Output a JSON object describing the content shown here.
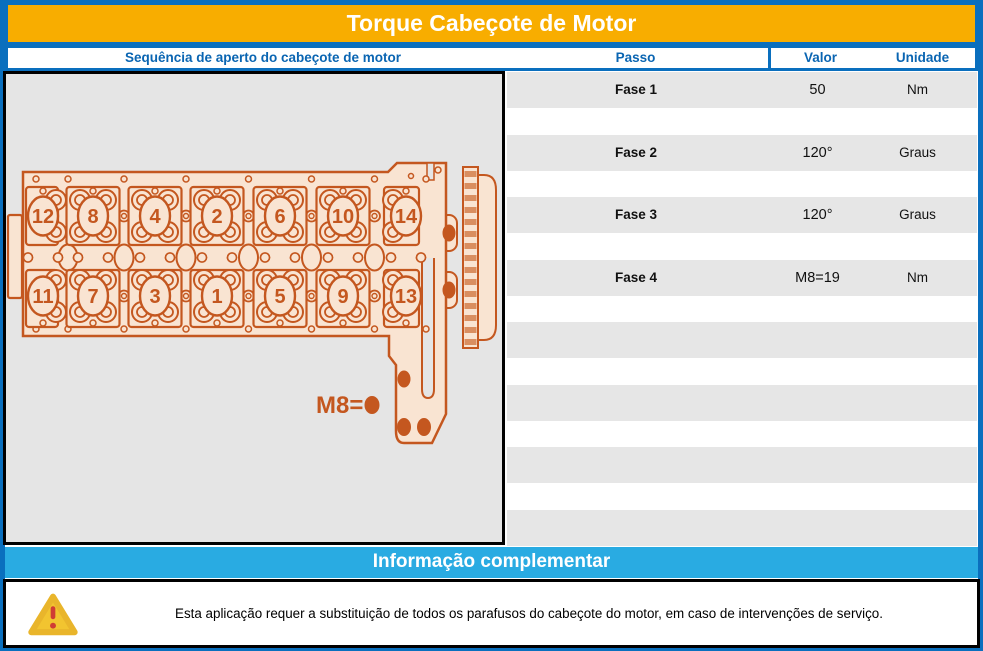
{
  "title": "Torque Cabeçote de Motor",
  "columns": {
    "sequence": "Sequência de aperto do cabeçote de motor",
    "passo": "Passo",
    "valor": "Valor",
    "unidade": "Unidade"
  },
  "torque_table": {
    "rows": [
      {
        "passo": "Fase 1",
        "valor": "50",
        "unidade": "Nm"
      },
      {
        "passo": "Fase 2",
        "valor": "120°",
        "unidade": "Graus"
      },
      {
        "passo": "Fase 3",
        "valor": "120°",
        "unidade": "Graus"
      },
      {
        "passo": "Fase 4",
        "valor": "M8=19",
        "unidade": "Nm"
      }
    ],
    "empty_rows": 4
  },
  "diagram": {
    "bolt_sequence_top": [
      12,
      8,
      4,
      2,
      6,
      10,
      14
    ],
    "bolt_sequence_bottom": [
      11,
      7,
      3,
      1,
      5,
      9,
      13
    ],
    "m8_label": "M8="
  },
  "info_bar": {
    "title": "Informação complementar"
  },
  "warning": {
    "text": "Esta aplicação requer a substituição de todos os parafusos do cabeçote do motor, em caso de intervenções de serviço."
  },
  "colors": {
    "frame_blue": "#0A6FBE",
    "header_text_blue": "#0A65B2",
    "title_orange": "#F8AD00",
    "info_cyan": "#29ABE2",
    "row_gray": "#E6E6E6",
    "panel_gray": "#E5E5E5",
    "diagram_orange": "#C4571F",
    "diagram_fill": "#F9E4D2",
    "gear_stripe": "#D98E60",
    "warning_yellow": "#F2C430",
    "warning_red": "#D03C34"
  }
}
